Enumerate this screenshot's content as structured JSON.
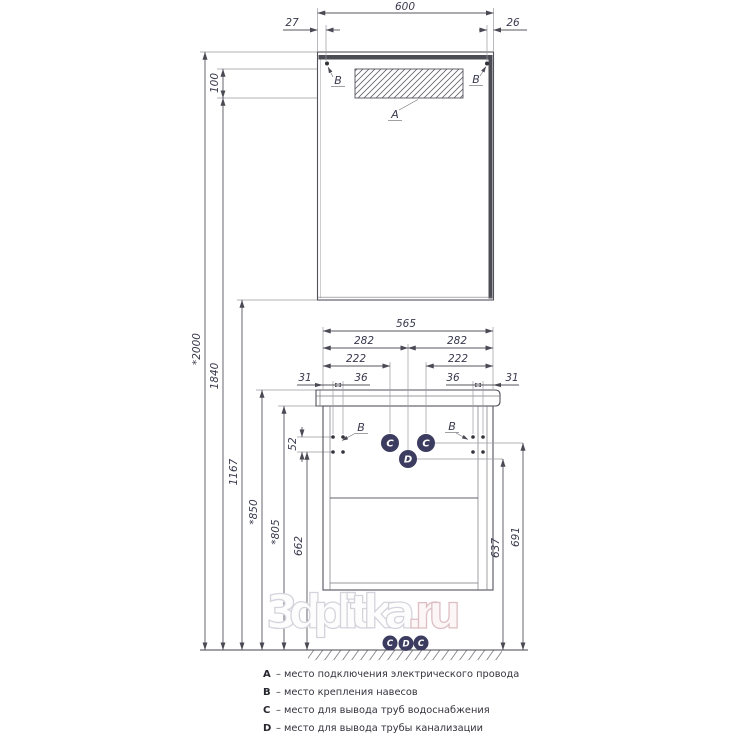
{
  "mirror": {
    "width": "600",
    "offset_left": "27",
    "offset_right": "26",
    "lamp_height": "100",
    "label_lamp": "A",
    "label_mount": "B"
  },
  "vanity": {
    "width": "565",
    "half_width": "282",
    "pipe_offset": "222",
    "mount_edge_offset": "31",
    "mount_spacing": "36",
    "mount_vertical_spacing": "52",
    "label_mount": "B",
    "label_water": "C",
    "label_drain": "D"
  },
  "heights": {
    "total": "*2000",
    "lamp_bottom": "1840",
    "mirror_bottom": "1167",
    "counter_top": "*850",
    "counter_bottom": "*805",
    "mount": "662",
    "drain": "637",
    "water": "691"
  },
  "legend": {
    "items": [
      {
        "key": "A",
        "text": "– место подключения электрического провода"
      },
      {
        "key": "B",
        "text": "– место крепления навесов"
      },
      {
        "key": "C",
        "text": "– место для вывода труб водоснабжения"
      },
      {
        "key": "D",
        "text": "– место для вывода трубы канализации"
      }
    ]
  },
  "watermark": {
    "name": "3dplitka",
    "tld": ".ru"
  },
  "colors": {
    "line": "#55555e",
    "dim_text": "#3a3a4e",
    "dark_strip": "#4c4c55",
    "marker_circle": "#3c3c60",
    "watermark": "#d4d4dc",
    "watermark_ru": "#ddbfc3"
  }
}
